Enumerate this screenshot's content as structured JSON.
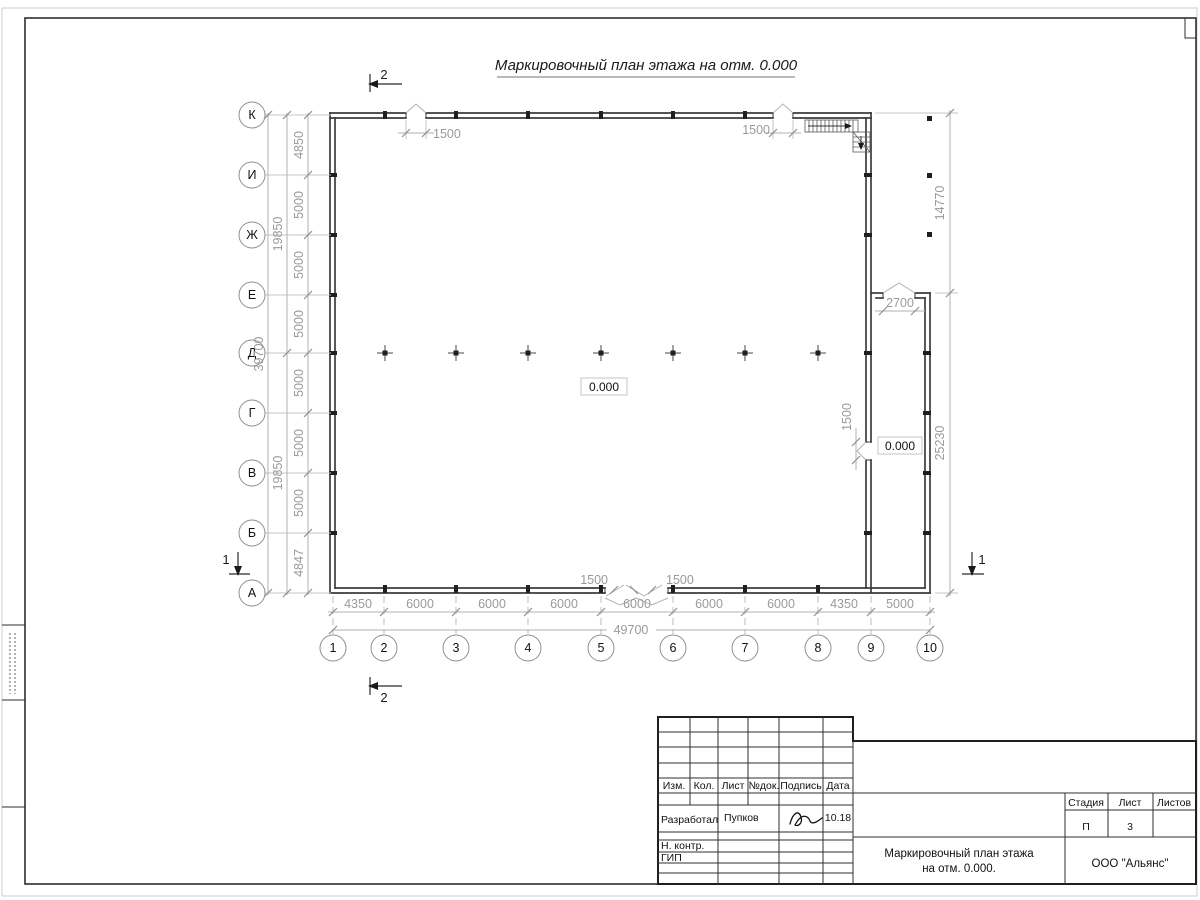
{
  "sheet": {
    "title": "Маркировочный план этажа на отм. 0.000"
  },
  "plan": {
    "axes_letters": [
      "К",
      "И",
      "Ж",
      "Е",
      "Д",
      "Г",
      "В",
      "Б",
      "А"
    ],
    "axes_numbers": [
      "1",
      "2",
      "3",
      "4",
      "5",
      "6",
      "7",
      "8",
      "9",
      "10"
    ],
    "dims_left": [
      "4850",
      "5000",
      "5000",
      "5000",
      "5000",
      "5000",
      "5000",
      "4847"
    ],
    "dims_left_sub": [
      "19850",
      "19850"
    ],
    "dims_left_total": "39700",
    "dims_bottom": [
      "4350",
      "6000",
      "6000",
      "6000",
      "6000",
      "6000",
      "6000",
      "4350",
      "5000"
    ],
    "dims_bottom_total": "49700",
    "dims_right": {
      "upper": "14770",
      "lower": "25230",
      "ext_opening": "2700",
      "door": "1500"
    },
    "openings_top": [
      "1500",
      "1500"
    ],
    "openings_bottom": [
      "1500",
      "1500"
    ],
    "elevation_center": "0.000",
    "elevation_ext": "0.000",
    "section_marks": {
      "top": "2",
      "bottom": "2",
      "left": "1",
      "right": "1"
    }
  },
  "titleblock": {
    "headers": [
      "Изм.",
      "Кол.",
      "Лист",
      "№док.",
      "Подпись",
      "Дата"
    ],
    "row_developer": {
      "role": "Разработал",
      "name": "Пупков",
      "date": "10.18"
    },
    "row_ncontrol": {
      "role": "Н. контр."
    },
    "row_gip": {
      "role": "ГИП"
    },
    "doc_title_line1": "Маркировочный план этажа",
    "doc_title_line2": "на отм. 0.000.",
    "company": "ООО \"Альянс\"",
    "stage_label": "Стадия",
    "sheet_label": "Лист",
    "sheets_label": "Листов",
    "stage_value": "П",
    "sheet_value": "3",
    "sheets_value": ""
  }
}
